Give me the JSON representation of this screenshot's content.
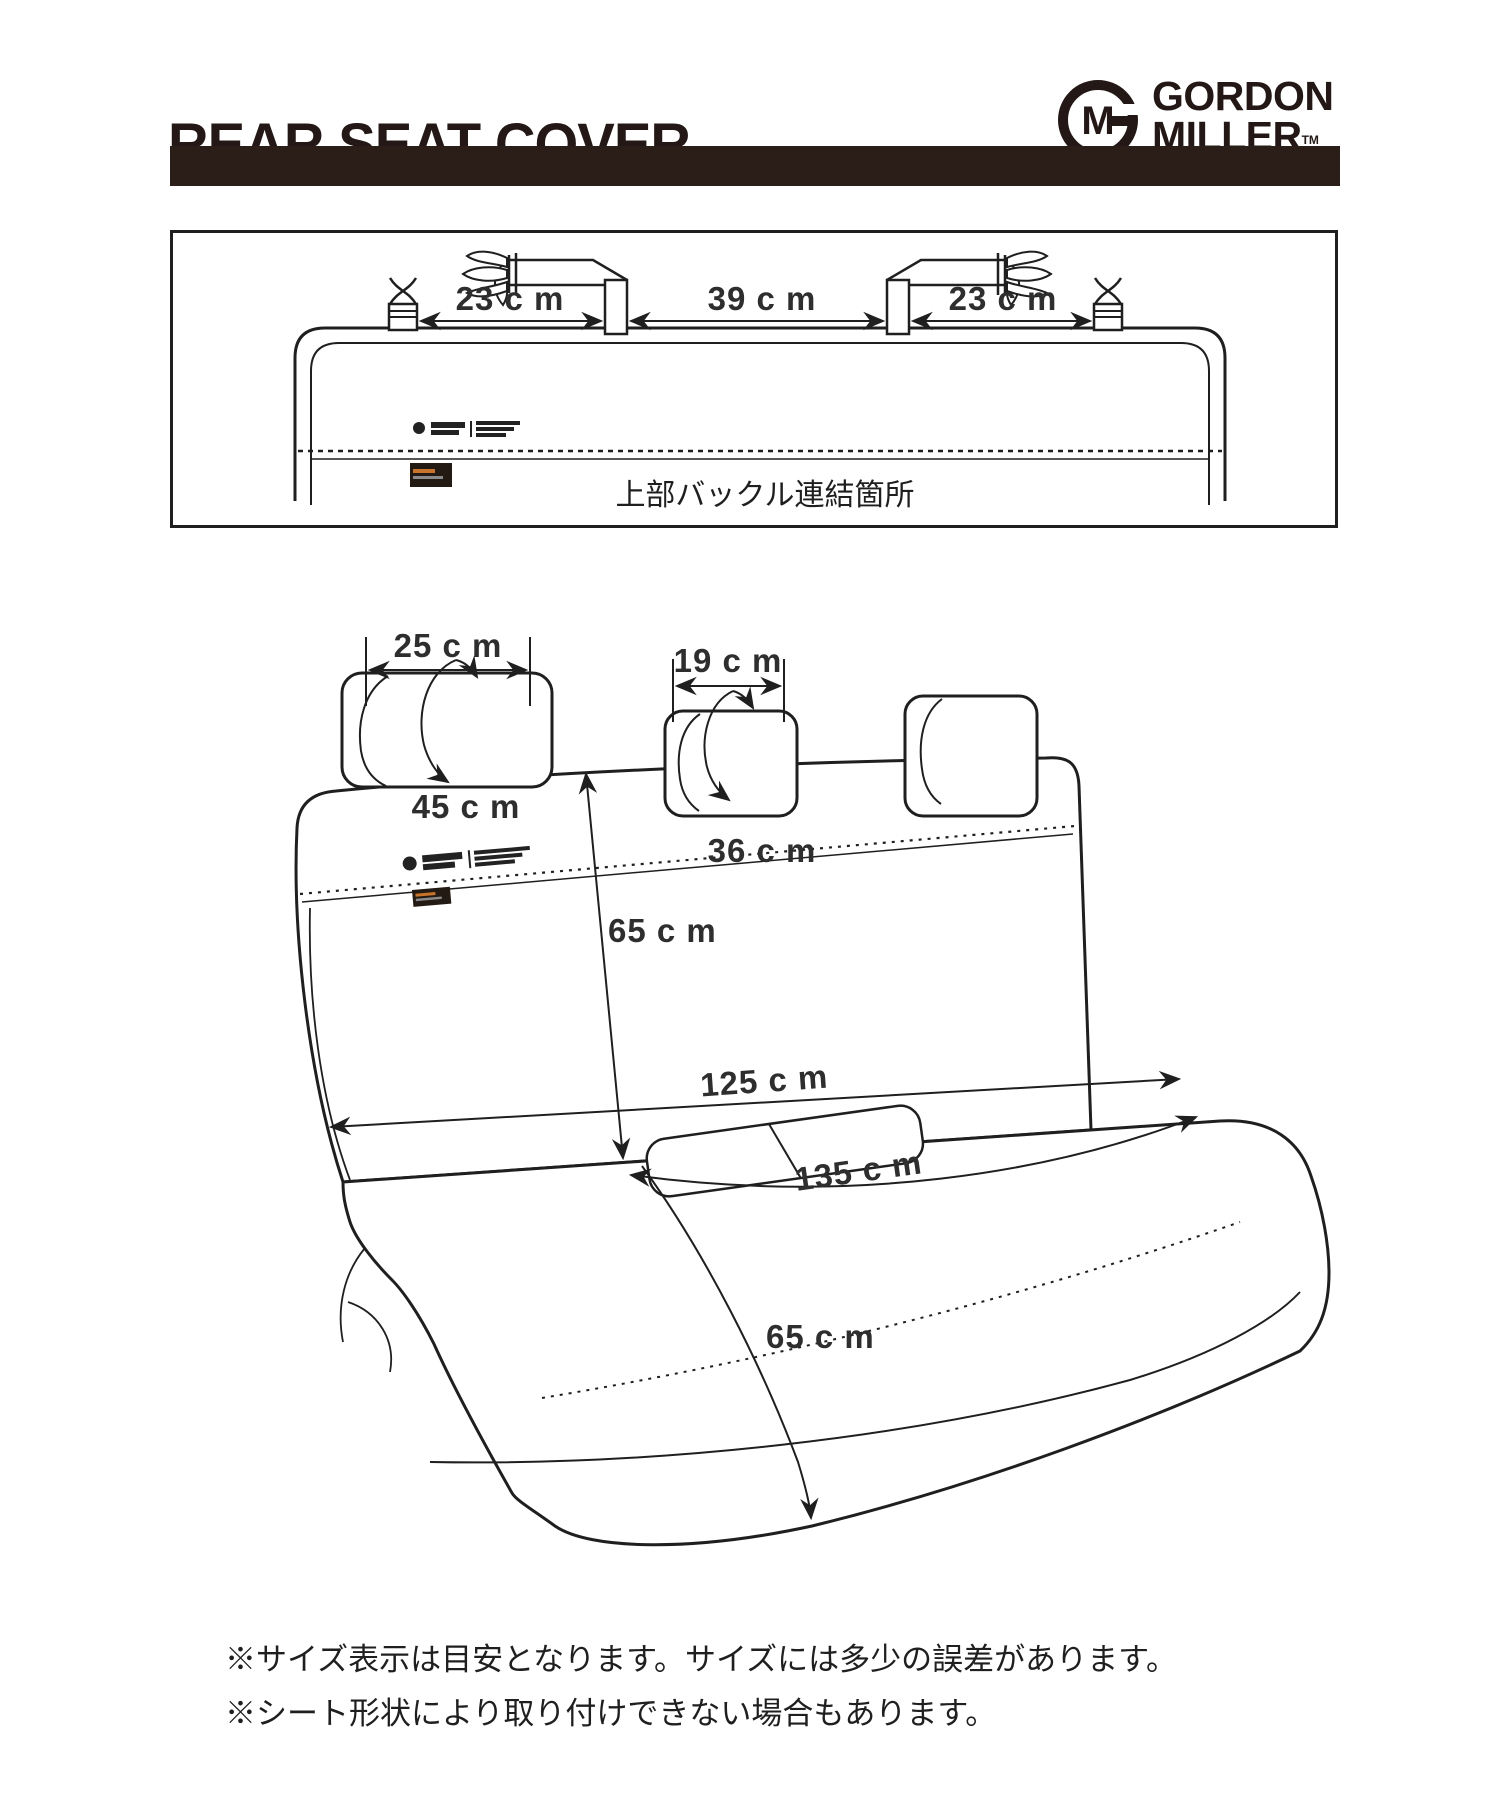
{
  "header": {
    "title": "REAR SEAT COVER",
    "brand": {
      "line1": "GORDON",
      "line2": "MILLER",
      "tm": "TM",
      "monogram": "GM"
    }
  },
  "top_diagram": {
    "dims": [
      {
        "label": "23 c m"
      },
      {
        "label": "39 c m"
      },
      {
        "label": "23 c m"
      }
    ],
    "caption": "上部バックル連結箇所",
    "printed_logo_text": "GORDON MILLER"
  },
  "main_diagram": {
    "dims": {
      "headrest_large_width": "25 c m",
      "headrest_small_width": "19 c m",
      "headrest_large_girth": "45 c m",
      "headrest_small_girth": "36 c m",
      "backrest_height": "65 c m",
      "backrest_width": "125 c m",
      "cushion_width": "135 c m",
      "cushion_depth": "65 c m"
    }
  },
  "notes": [
    "※サイズ表示は目安となります。サイズには多少の誤差があります。",
    "※シート形状により取り付けできない場合もあります。"
  ],
  "colors": {
    "ink": "#1f1f1f",
    "brand_ink": "#231815",
    "bar": "#2b1e19",
    "label_text": "#2e2e2e"
  }
}
